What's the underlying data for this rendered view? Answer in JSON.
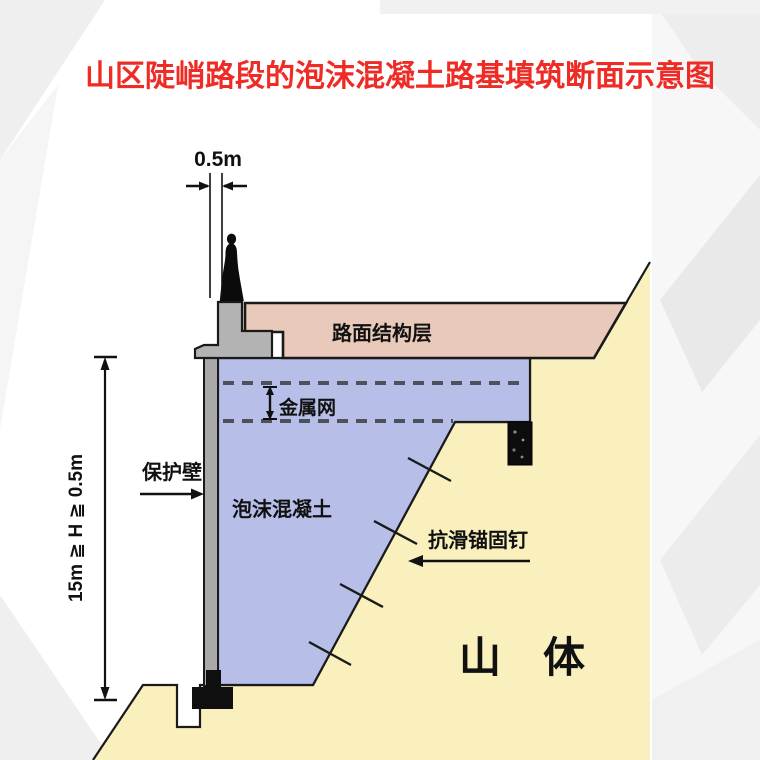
{
  "title": {
    "text": "山区陡峭路段的泡沫混凝土路基填筑断面示意图"
  },
  "dims": {
    "width_label": "0.5m",
    "height_label": "15m ≧ H ≧ 0.5m"
  },
  "labels": {
    "pavement": "路面结构层",
    "metal_mesh": "金属网",
    "protection_wall": "保护壁",
    "foam_concrete": "泡沫混凝土",
    "anchor_nails": "抗滑锚固钉",
    "mountain": "山　体"
  },
  "colors": {
    "title_red": "#ee2b25",
    "pavement_fill": "#e8c9ba",
    "foam_fill": "#b7bee8",
    "mountain_fill": "#faf0bd",
    "wall_gray": "#a9a9a9",
    "barrier_gray": "#b3b3b3",
    "outline": "#1a1a1a",
    "dash_line": "#50505c"
  }
}
